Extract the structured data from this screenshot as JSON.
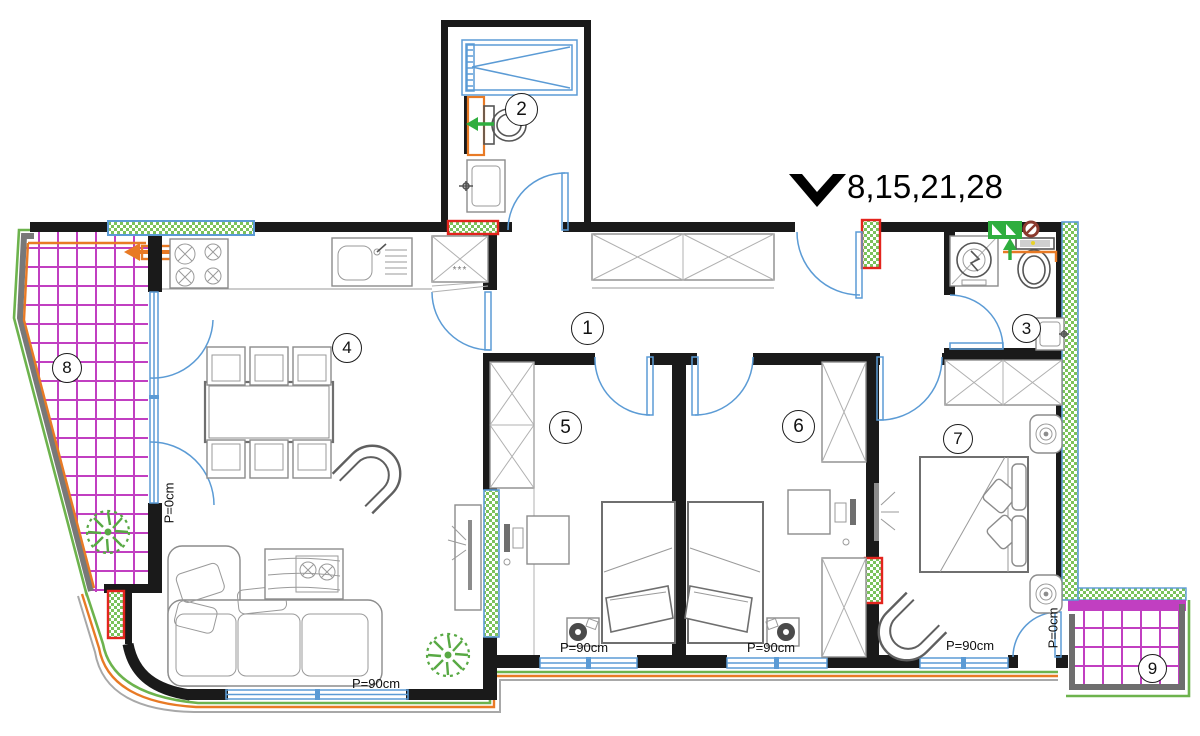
{
  "header": {
    "marker_label": "8,15,21,28"
  },
  "rooms": {
    "r1": "1",
    "r2": "2",
    "r3": "3",
    "r4": "4",
    "r5": "5",
    "r6": "6",
    "r7": "7",
    "r8": "8",
    "r9": "9"
  },
  "dims": {
    "p0": "P=0cm",
    "p90": "P=90cm"
  },
  "symbols": {
    "freezer_stars": "***"
  },
  "markers": [
    {
      "name": "section-marker-triangle",
      "color": "#000000"
    },
    {
      "name": "flue-arrow-left-terrace",
      "color": "#e87a25"
    },
    {
      "name": "vent-arrow-left-bathroom-2",
      "color": "#2fae3e"
    },
    {
      "name": "vent-arrow-up-bathroom-3",
      "color": "#2fae3e"
    },
    {
      "name": "vent-grille-bathroom-3",
      "color": "#2fae3e"
    },
    {
      "name": "no-entry-symbol-bathroom-3",
      "color": "#8b3a2e"
    }
  ],
  "colors": {
    "wall": "#1a1a1a",
    "opening_blue": "#5b9bd5",
    "tile_magenta": "#c13fc1",
    "accent_green": "#6db34d",
    "accent_orange": "#e87a25",
    "accent_red": "#e3241d",
    "railing_gray": "#787878",
    "hatch_green": "#7bc25b"
  }
}
